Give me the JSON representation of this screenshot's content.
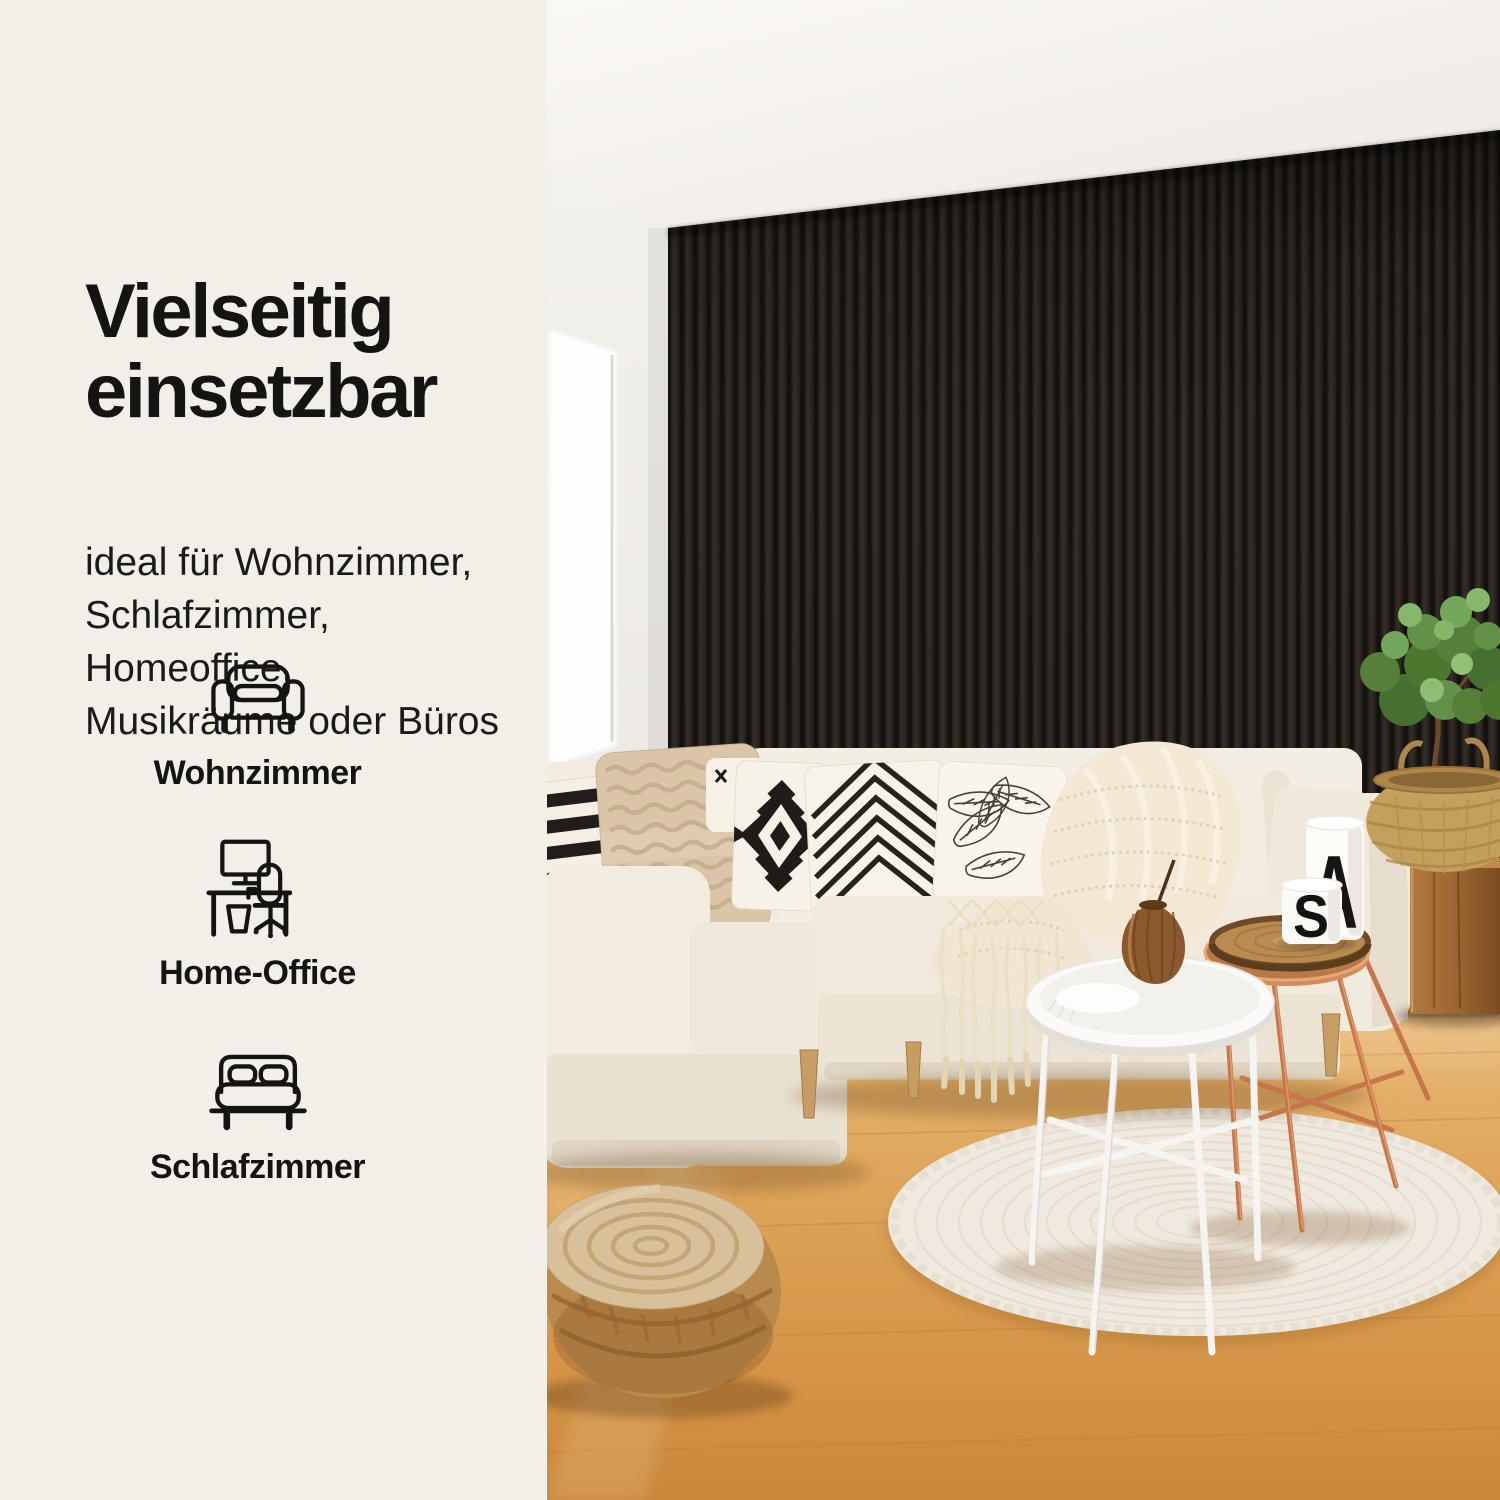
{
  "panel": {
    "headline": [
      "Vielseitig",
      "einsetzbar"
    ],
    "subtext": [
      "ideal für Wohnzimmer,",
      "Schlafzimmer, Homeoffice,",
      "Musikräume oder Büros"
    ],
    "features": [
      {
        "icon": "sofa-icon",
        "label": "Wohnzimmer"
      },
      {
        "icon": "desk-icon",
        "label": "Home-Office"
      },
      {
        "icon": "bed-icon",
        "label": "Schlafzimmer"
      }
    ],
    "colors": {
      "background": "#F2EFE8",
      "text": "#151412"
    }
  },
  "photo": {
    "mug_letters": {
      "small": "S",
      "large": "A"
    },
    "colors": {
      "slat_wall_face": "#2C2722",
      "slat_wall_gap": "#151110",
      "ceiling": "#F1EEE9",
      "side_wall": "#F2F0EC",
      "window_light": "#FFFFFF",
      "floor_light": "#E7BC7E",
      "floor_deep": "#CE8C3E",
      "sofa_cream": "#F1EADD",
      "rug": "#EFE9DF",
      "pouf": "#BA8A4C",
      "copper_table": "#C77F50",
      "white_table": "#FBFAF8",
      "wood_stool": "#9A6430",
      "basket": "#C4A05E",
      "plant": "#5E8C42"
    }
  }
}
